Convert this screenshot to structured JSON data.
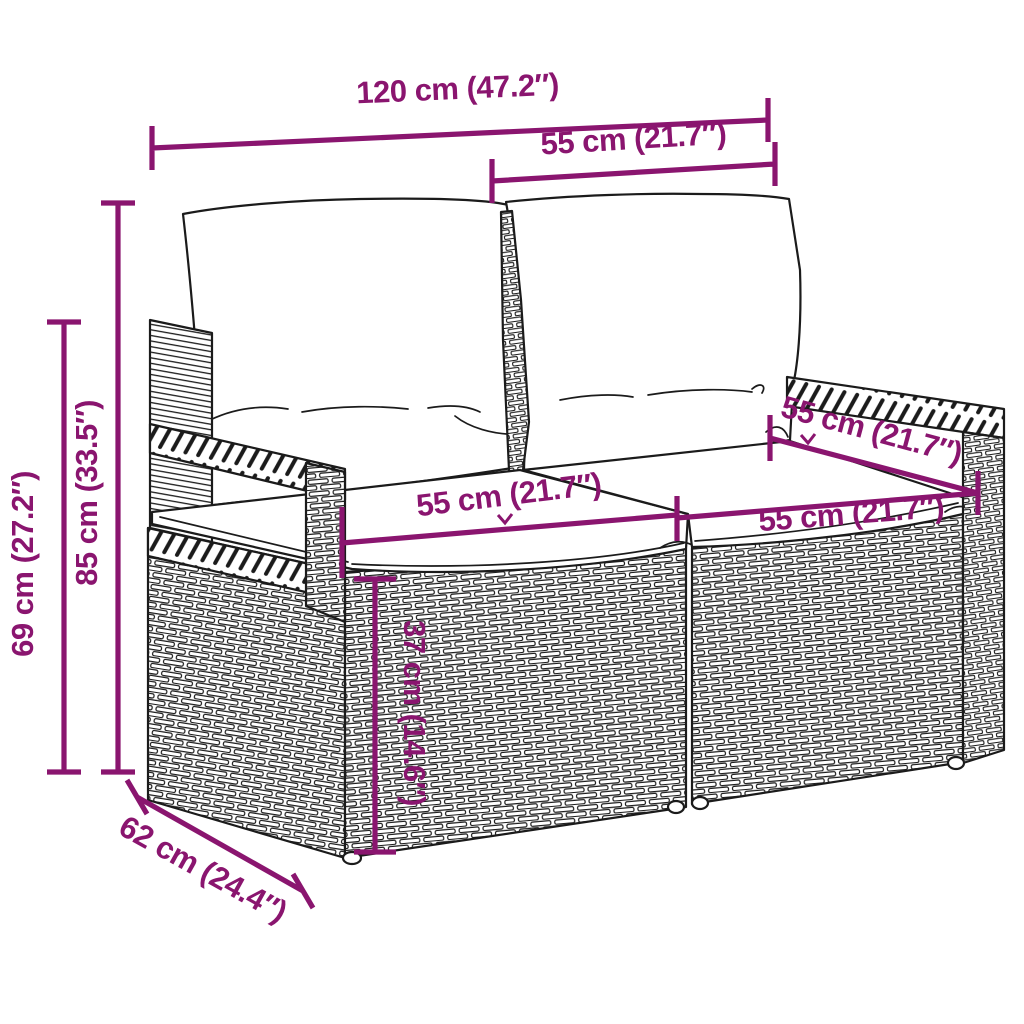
{
  "diagram": {
    "type": "product-dimension-diagram",
    "subject": "poly-rattan 2-seater garden sofa with cushions",
    "accent_color": "#8A156F",
    "outline_color": "#1b1b1b",
    "background": "#ffffff",
    "labels": {
      "total_width": "120 cm (47.2″)",
      "back_cushion_width": "55 cm (21.7″)",
      "overall_height": "85 cm (33.5″)",
      "armrest_height": "69 cm (27.2″)",
      "left_seat_width": "55 cm (21.7″)",
      "seat_depth": "55 cm (21.7″)",
      "right_seat_width": "55 cm (21.7″)",
      "seat_height": "37 cm (14.6″)",
      "overall_depth": "62 cm (24.4″)"
    }
  }
}
